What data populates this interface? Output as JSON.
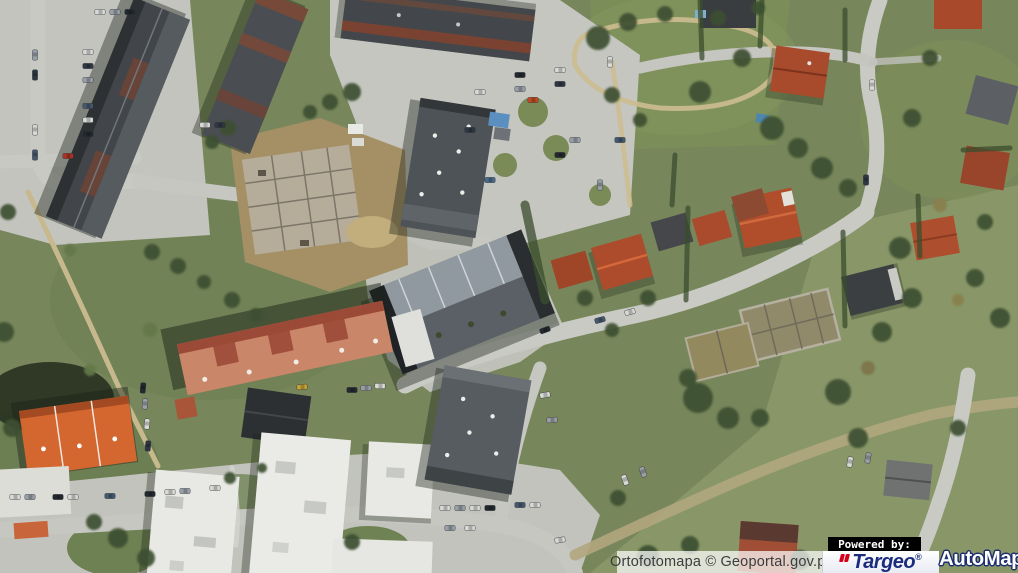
{
  "attribution": {
    "text": "Ortofotomapa © Geoportal.gov.pl"
  },
  "branding": {
    "powered_by": "Powered by:",
    "targeo": {
      "name": "Targeo",
      "registered": "®"
    },
    "automapa": {
      "name": "AutoMapa",
      "registered": "®"
    }
  },
  "icons": {
    "targeo_quote_icon": "double-red-quote-mark"
  },
  "colors": {
    "targeo_blue": "#1b2c7c",
    "targeo_red": "#d6001c",
    "automapa_text": "#ffffff",
    "automapa_outline": "#1e2f6f",
    "powered_by_bg": "#000000",
    "powered_by_text": "#ffffff",
    "attribution_bg": "rgba(255,255,255,0.72)",
    "attribution_text": "#3c3c3c"
  }
}
